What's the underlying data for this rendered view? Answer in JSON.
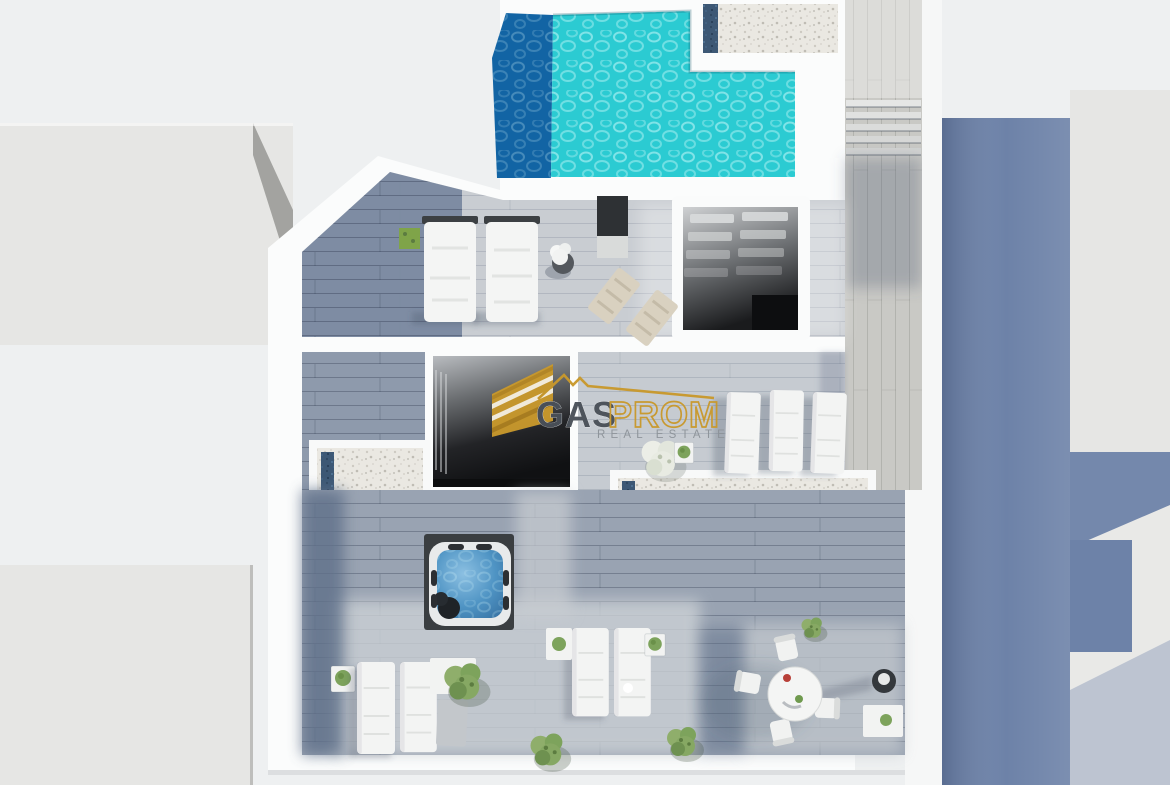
{
  "page": {
    "title": "Rooftop terrace 3D top-down render"
  },
  "watermark": {
    "brand_dark": "GAS",
    "brand_gold": "PROM",
    "tagline": "REAL ESTATE"
  },
  "palette": {
    "background": "#eef0f1",
    "neighbor_block": "#e6e6e4",
    "neighbor_block_side": "#a3a3a0",
    "wall_white": "#fbfcfc",
    "deck_sunlit": "#c9cdd2",
    "deck_shadow": "#76859d",
    "deck_bottom": "#99a3b2",
    "walkway_wood": "#c9c9c5",
    "pool_turquoise": "#2bcbd2",
    "pool_deep": "#1264a4",
    "jacuzzi_water": "#4f94c4",
    "gravel": "#eae8e2",
    "gravel_blue": "#3d5875",
    "void_dark": "#16171a",
    "blue_wall": "#6d82a8",
    "plant_green": "#83a25d",
    "logo_gold": "#c9992c",
    "logo_dark": "#4a5058",
    "logo_gray": "#8d9399"
  },
  "scene": {
    "type": "3d-top-down-architectural-render",
    "areas": [
      "swimming-pool",
      "pool-deep-end",
      "gravel-roof-strips",
      "stairwell-skylight",
      "courtyard-void",
      "upper-sun-deck",
      "lower-sun-deck",
      "side-walkway-stairs",
      "jacuzzi",
      "sun-loungers",
      "deck-chairs",
      "dining-set",
      "planters"
    ]
  }
}
